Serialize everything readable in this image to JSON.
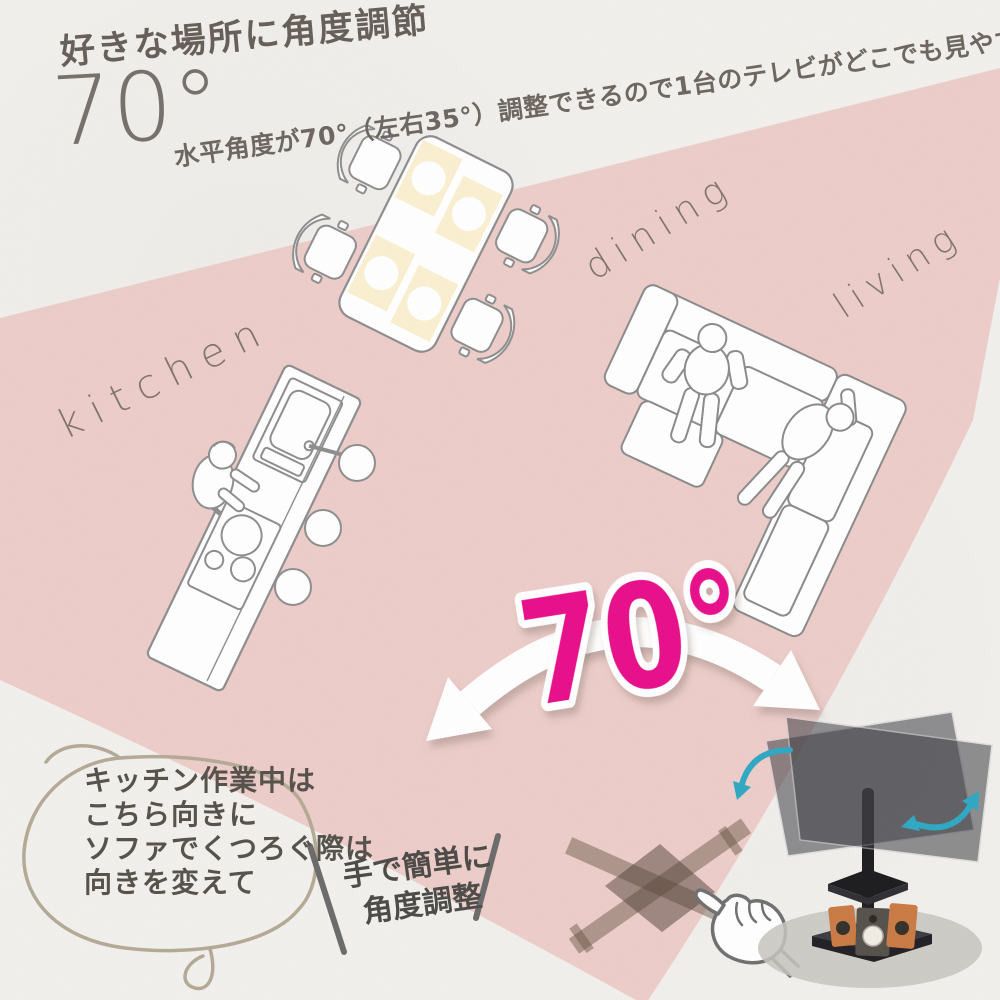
{
  "header": {
    "title": "好きな場所に角度調節",
    "angle_badge": "70°",
    "subtitle": "水平角度が70°（左右35°）調整できるので1台のテレビがどこでも見やすく。"
  },
  "floorplan": {
    "kitchen_label": "kitchen",
    "dining_label": "dining",
    "living_label": "living"
  },
  "swivel": {
    "angle_text": "70°"
  },
  "bubble": {
    "line1": "キッチン作業中は",
    "line2": "こちら向きに",
    "line3": "ソファでくつろぐ際は",
    "line4": "向きを変えて"
  },
  "hand_note": {
    "line1": "手で簡単に",
    "line2": "角度調整"
  },
  "colors": {
    "paper": "#f2f0ec",
    "pink_wedge": "#ecccc9",
    "accent_magenta": "#e80b8a",
    "teal_arrow": "#2ea7c3",
    "line_art": "#8d8d8d"
  }
}
